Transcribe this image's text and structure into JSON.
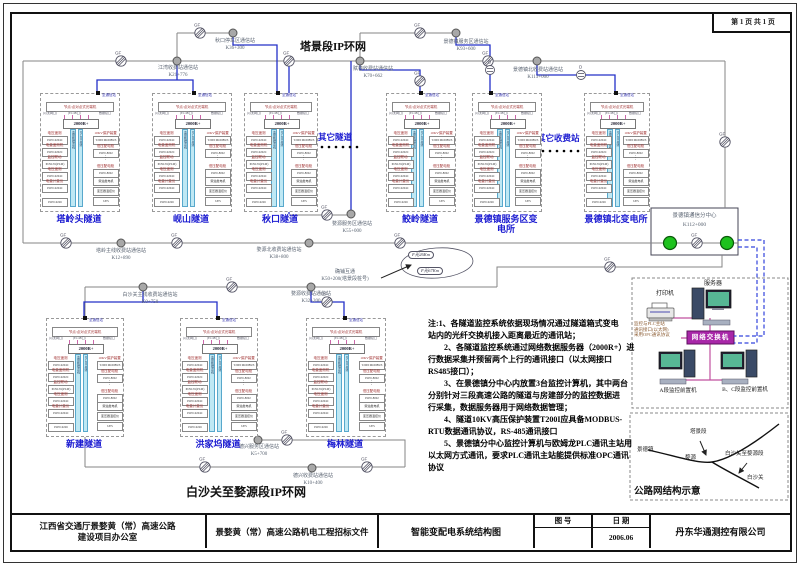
{
  "page": {
    "sheet_label": "第 1 页 共 1 页"
  },
  "titles": {
    "top_ring": "塔景段IP环网",
    "bottom_ring": "白沙关至婺源段IP环网"
  },
  "others": {
    "other_tunnels": "其它隧道",
    "other_tolls": "其它收费站"
  },
  "symbols": {
    "gf": "GF",
    "d": "D"
  },
  "stations": [
    {
      "name": "江湾收费站通信站",
      "km": "K21+776"
    },
    {
      "name": "秋口停车区通信站",
      "km": "K36+300"
    },
    {
      "name": "赋春收费站通信站",
      "km": "K70+662"
    },
    {
      "name": "景德镇服务区通信站",
      "km": "K93+600"
    },
    {
      "name": "景德镇北收费站通信站",
      "km": "K113+000"
    },
    {
      "name": "塔岭主线收费站通信站",
      "km": "K12+890"
    },
    {
      "name": "婺源服务区通信站",
      "km": "K55+000"
    },
    {
      "name": "婺源北收费站通信站",
      "km": "K38+800"
    },
    {
      "name": "白沙关主线收费站通信站",
      "km": "K0+750"
    },
    {
      "name": "婺源收费站通信站",
      "km": "K32+200"
    },
    {
      "name": "德兴服务区通信站",
      "km": "K5+700"
    },
    {
      "name": "德兴收费站通信站",
      "km": "K10+400"
    }
  ],
  "transfer": {
    "name": "确铺互通",
    "km": "K50+200(塔景段桩号)",
    "fiber_tags": [
      "F光26Km",
      "F光67Km"
    ]
  },
  "center": {
    "name": "景德镇通信分中心",
    "km": "K112+000"
  },
  "equipment": {
    "printer": "打印机",
    "server": "服务器",
    "switch": "网络交换机",
    "pc_a": "A段监控前置机",
    "pc_bc": "B、C段监控前置机",
    "plc_note_lines": [
      "监控与PLC主站",
      "通讯接口(以太网)",
      "采用OPC通讯协议"
    ]
  },
  "sketch": {
    "title": "公路网结构示意",
    "labels": {
      "jdz": "景德镇",
      "tj": "塔景段",
      "wy": "婺源",
      "seg": "白沙关至婺源段",
      "bsg": "白沙关"
    }
  },
  "notes": {
    "lines": [
      "注:1、各隧道监控系统依据现场情况通过隧道箱式变电",
      "站内的光纤交换机接入距离最近的通讯站；",
      "　　2、各隧道监控系统通过网络数据服务器（2000R+）进",
      "行数据采集并预留两个上行的通讯接口（以太网接口",
      "RS485接口）；",
      "　　3、在景德镇分中心内放置3台监控计算机，其中两台",
      "分别针对三段高速公路的隧道与房建部分的监控数据进",
      "行采集，数据服务器用于网络数据管理；",
      "　　4、隧道10KV高压保护装置T200I应具备MODBUS-",
      "RTU数据通讯协议，RS-485通讯接口",
      "　　5、景德镇分中心监控计算机与欧姆龙PLC通讯主站用",
      "以太网方式通讯，要求PLC通讯主站能提供标准OPC通讯",
      "协议"
    ]
  },
  "rack": {
    "to_station": "至通信站",
    "transceiver": "节点/点对点式光端机",
    "ports": [
      "(以太网口)",
      "(E1/4B口)",
      "数据接口"
    ],
    "server": "2000R+",
    "bus": [
      "监控数据总线",
      "RS-485总线"
    ],
    "left": [
      {
        "label": "电压遥测",
        "box": "POW-9204C"
      },
      {
        "label": "电量遥测机",
        "box": "POW-9202C"
      },
      {
        "label": "监控联动",
        "box": "POW-81(PLM)"
      },
      {
        "label": "电压遥测",
        "box": "POW-9204C"
      },
      {
        "label": "电量计量仪",
        "box": "POW-9204C"
      },
      {
        "label": "",
        "box": "POW-9226"
      }
    ],
    "right": [
      {
        "label": "10KV保护装置",
        "box": "T200I MODBUS"
      },
      {
        "label": "低压配电柜",
        "box": "POW-8002"
      },
      {
        "label": "",
        "box": "⋮"
      },
      {
        "label": "低压配电柜",
        "box": "POW-8002"
      },
      {
        "label": "",
        "box": "柴油发电机"
      },
      {
        "label": "",
        "box": "变压器温控仪"
      },
      {
        "label": "",
        "box": "UPS"
      }
    ]
  },
  "tunnels": [
    {
      "name": "塔岭头隧道"
    },
    {
      "name": "岘山隧道"
    },
    {
      "name": "秋口隧道"
    },
    {
      "name": "鲛岭隧道"
    },
    {
      "name": "景德镇服务区变电所"
    },
    {
      "name": "景德镇北变电所"
    },
    {
      "name": "新建隧道"
    },
    {
      "name": "洪家坞隧道"
    },
    {
      "name": "梅林隧道"
    }
  ],
  "titleblock": {
    "owner_l1": "江西省交通厅景婺黄（常）高速公路",
    "owner_l2": "建设项目办公室",
    "doc": "景婺黄（常）高速公路机电工程招标文件",
    "drawing": "智能变配电系统结构图",
    "no_label": "图  号",
    "no_value": "",
    "date_label": "日  期",
    "date_value": "2006.06",
    "company": "丹东华通测控有限公司"
  }
}
